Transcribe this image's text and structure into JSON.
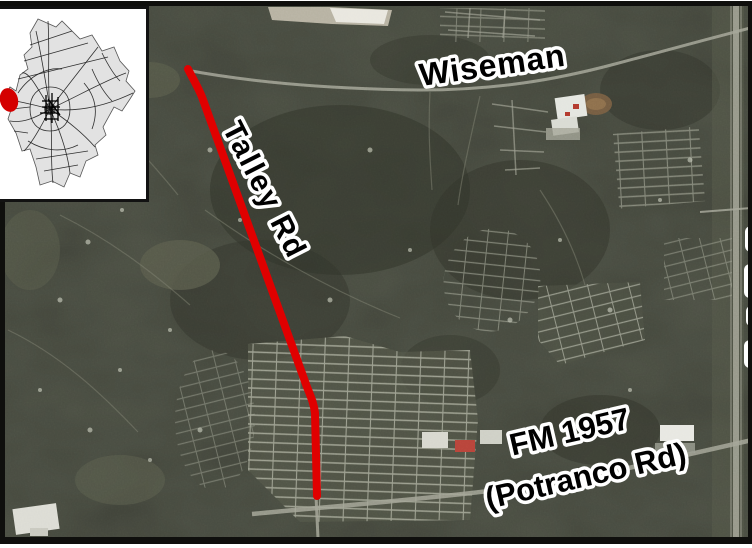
{
  "figure_labels": {
    "wiseman": "Wiseman",
    "talley_rd": "Talley Rd",
    "fm_line1": "FM 1957",
    "fm_line2": "(Potranco Rd)"
  },
  "colors": {
    "highlight_red": "#e00000",
    "inset_marker_red": "#d40000",
    "label_fill": "#000000",
    "label_outline": "#ffffff",
    "aerial_base": "#41443a",
    "frame_black": "#0f0f0d",
    "inset_background": "#ffffff"
  }
}
